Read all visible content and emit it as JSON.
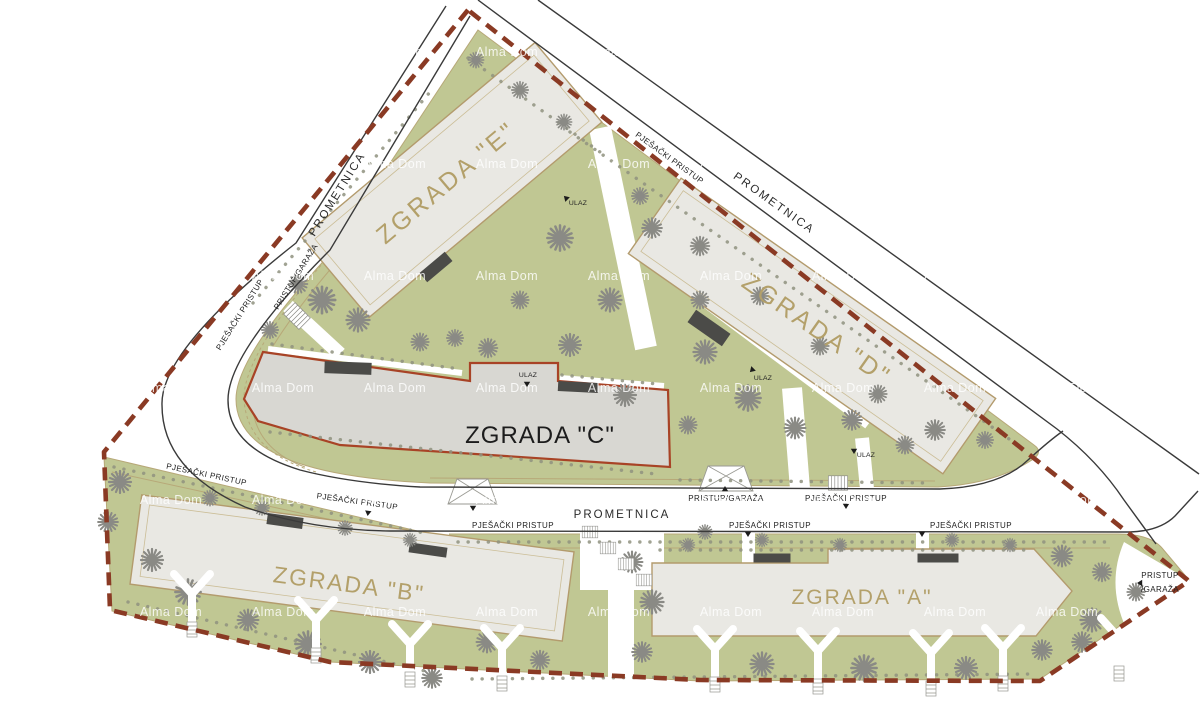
{
  "plan": {
    "title": "Site plan with buildings A-E",
    "buildings": [
      {
        "id": "A",
        "label": "ZGRADA \"A\""
      },
      {
        "id": "B",
        "label": "ZGRADA \"B\""
      },
      {
        "id": "C",
        "label": "ZGRADA \"C\""
      },
      {
        "id": "D",
        "label": "ZGRADA \"D\""
      },
      {
        "id": "E",
        "label": "ZGRADA \"E\""
      }
    ],
    "road_label": "PROMETNICA",
    "labels": {
      "pedestrian_access": "PJEŠAČKI PRISTUP",
      "entrance": "ULAZ",
      "garage_access": "PRISTUP/GARAŽA",
      "garage_access_line1": "PRISTUP",
      "garage_access_line2": "/GARAŽA"
    },
    "watermark": "Alma Dom",
    "colors": {
      "green": "#c0c793",
      "building_fill": "#e9e8e3",
      "building_stroke": "#b39b6d",
      "building_c_fill": "#d8d7d2",
      "building_c_stroke": "#a84326",
      "boundary": "#8a3a24",
      "road_line": "#3a3a3a",
      "tree": "#8a8a85",
      "label_tan": "#b3a06a",
      "label_dark": "#1c1c1c"
    }
  }
}
